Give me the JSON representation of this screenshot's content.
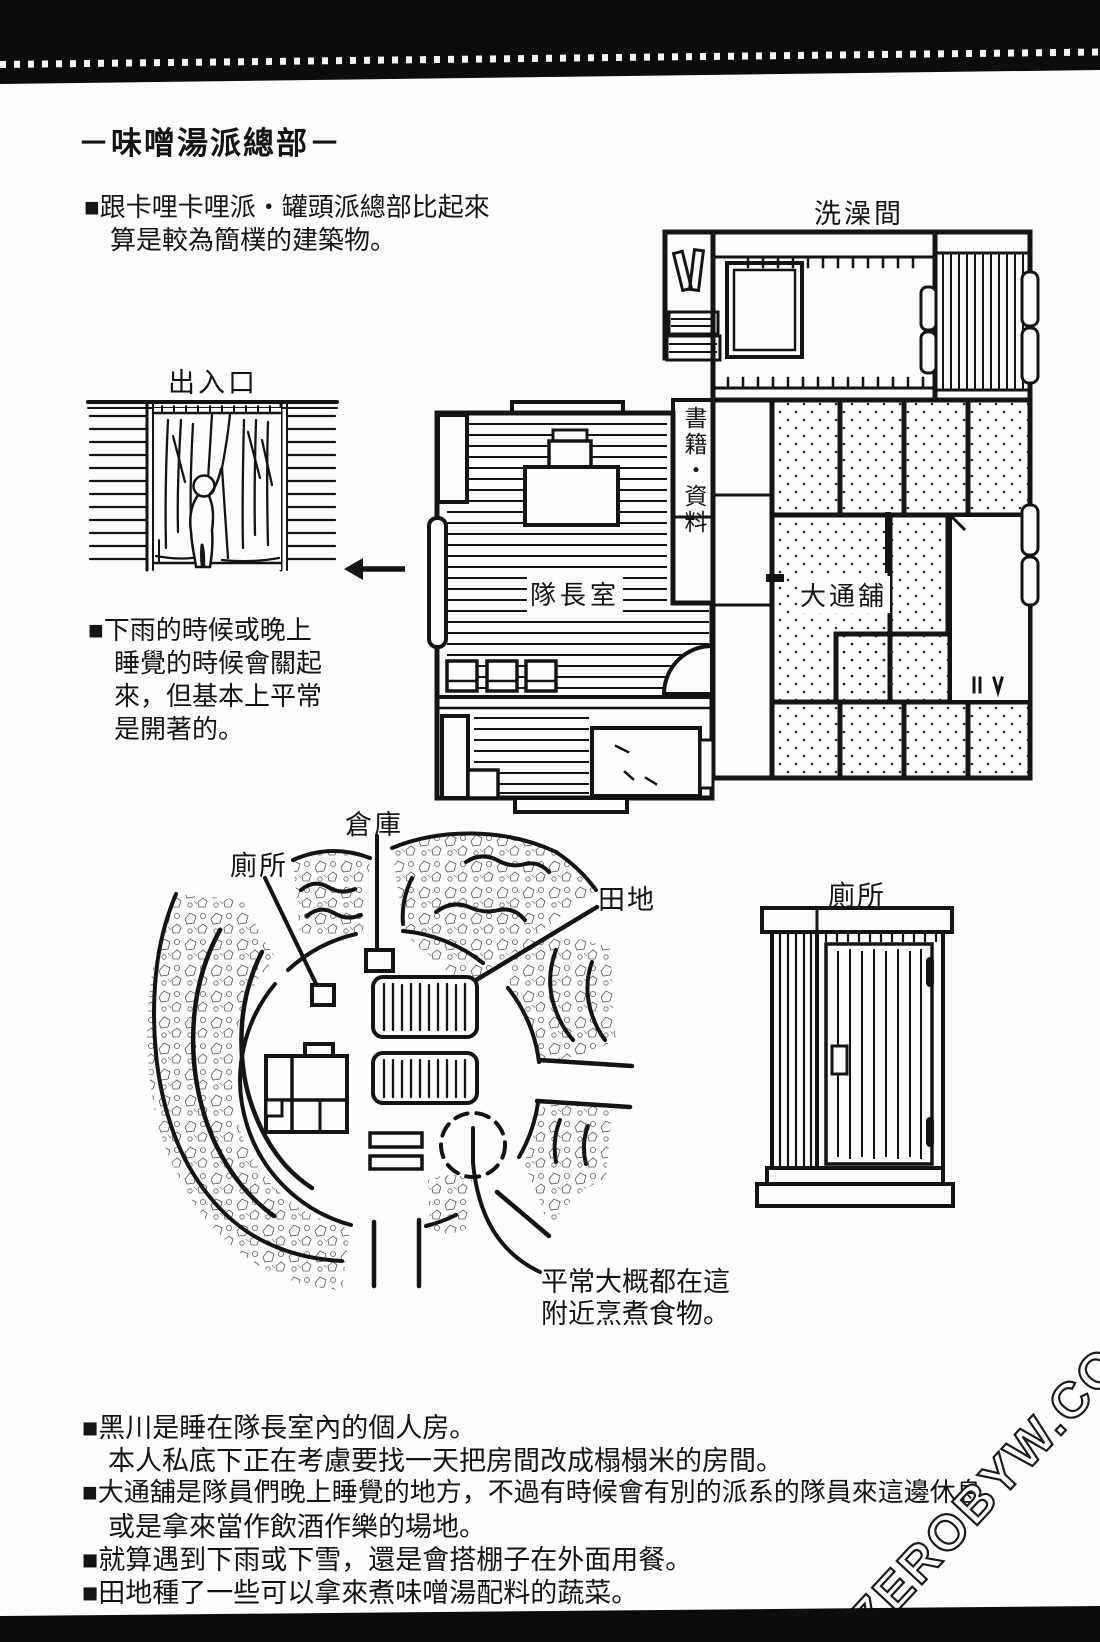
{
  "colors": {
    "ink": "#141414",
    "paper": "#fdfdfd"
  },
  "header": {
    "title": "－味噌湯派總部－",
    "intro_line1": "■跟卡哩卡哩派・罐頭派總部比起來",
    "intro_line2": "算是較為簡樸的建築物。"
  },
  "floor_plan": {
    "bath_label": "洗澡間",
    "books_label": "書籍・資料",
    "captain_label": "隊長室",
    "bunk_label": "大通舖"
  },
  "entrance": {
    "label": "出入口",
    "note_lines": [
      "■下雨的時候或晚上",
      "睡覺的時候會關起",
      "來，但基本上平常",
      "是開著的。"
    ]
  },
  "map": {
    "toilet_label": "廁所",
    "storage_label": "倉庫",
    "field_label": "田地",
    "outhouse_label": "廁所",
    "cooking_line1": "平常大概都在這",
    "cooking_line2": "附近烹煮食物。"
  },
  "notes": {
    "lines": [
      "■黑川是睡在隊長室內的個人房。",
      "本人私底下正在考慮要找一天把房間改成榻榻米的房間。",
      "■大通舖是隊員們晚上睡覺的地方，不過有時候會有別的派系的隊員來這邊休息",
      "或是拿來當作飲酒作樂的場地。",
      "■就算遇到下雨或下雪，還是會搭棚子在外面用餐。",
      "■田地種了一些可以拿來煮味噌湯配料的蔬菜。"
    ]
  },
  "watermark": "ZEROBYW.COM"
}
